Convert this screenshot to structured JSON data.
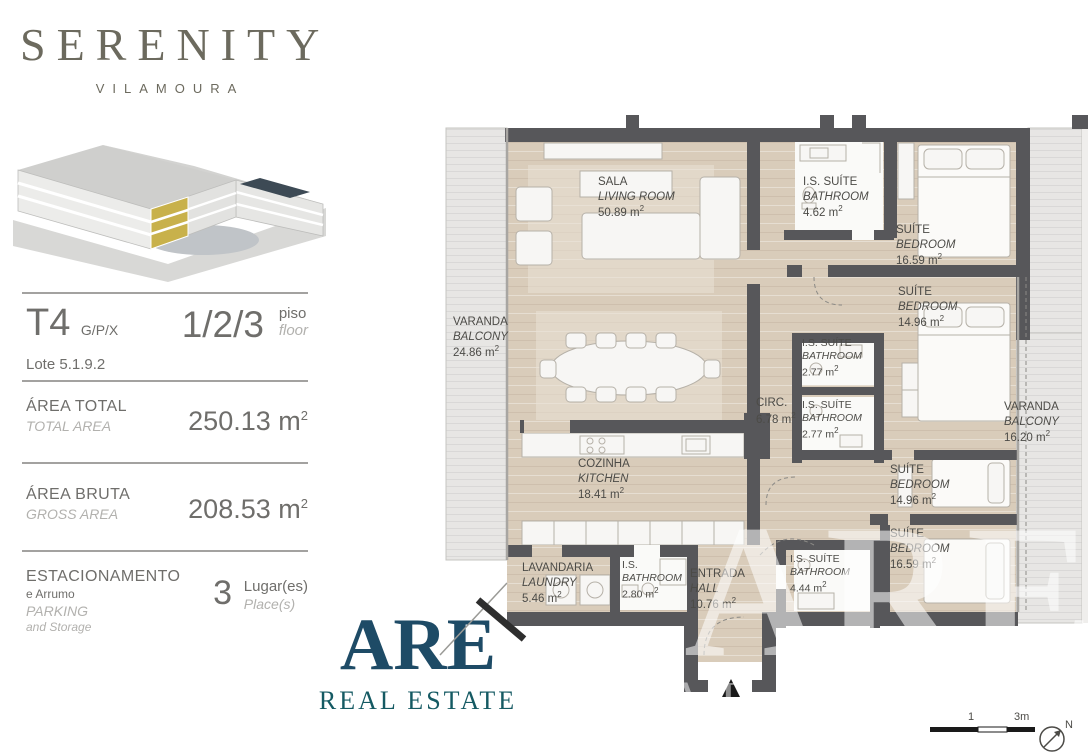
{
  "brand": {
    "name": "SERENITY",
    "location": "VILAMOURA"
  },
  "unit": {
    "type": "T4",
    "type_suffix": "G/P/X",
    "floors": "1/2/3",
    "floors_label_pt": "piso",
    "floors_label_en": "floor",
    "lot": "Lote 5.1.9.2",
    "unit_symbol": "m",
    "unit_exp": "2",
    "area_total": {
      "label_pt": "ÁREA TOTAL",
      "label_en": "TOTAL AREA",
      "value": "250.13"
    },
    "area_gross": {
      "label_pt": "ÁREA BRUTA",
      "label_en": "GROSS AREA",
      "value": "208.53"
    },
    "parking": {
      "label_pt": "ESTACIONAMENTO",
      "label_pt_sub": "e Arrumo",
      "label_en": "PARKING",
      "label_en_sub": "and Storage",
      "value": "3",
      "unit_pt": "Lugar(es)",
      "unit_en": "Place(s)"
    }
  },
  "agency": {
    "name": "ARE",
    "tagline": "REAL ESTATE"
  },
  "floorplan": {
    "unit_symbol": "m",
    "unit_exp": "2",
    "rooms": [
      {
        "id": "living",
        "pt": "SALA",
        "en": "LIVING ROOM",
        "area": "50.89"
      },
      {
        "id": "bath-suite-1",
        "pt": "I.S. SUÍTE",
        "en": "BATHROOM",
        "area": "4.62"
      },
      {
        "id": "suite-1",
        "pt": "SUÍTE",
        "en": "BEDROOM",
        "area": "16.59"
      },
      {
        "id": "suite-2",
        "pt": "SUÍTE",
        "en": "BEDROOM",
        "area": "14.96"
      },
      {
        "id": "balcony-left",
        "pt": "VARANDA",
        "en": "BALCONY",
        "area": "24.86"
      },
      {
        "id": "bath-suite-2",
        "pt": "I.S. SUÍTE",
        "en": "BATHROOM",
        "area": "2.77"
      },
      {
        "id": "circulation",
        "pt": "CIRC.",
        "en": "",
        "area": "6.78"
      },
      {
        "id": "bath-suite-3",
        "pt": "I.S. SUÍTE",
        "en": "BATHROOM",
        "area": "2.77"
      },
      {
        "id": "balcony-right",
        "pt": "VARANDA",
        "en": "BALCONY",
        "area": "16.20"
      },
      {
        "id": "kitchen",
        "pt": "COZINHA",
        "en": "KITCHEN",
        "area": "18.41"
      },
      {
        "id": "suite-3",
        "pt": "SUÍTE",
        "en": "BEDROOM",
        "area": "14.96"
      },
      {
        "id": "suite-4",
        "pt": "SUÍTE",
        "en": "BEDROOM",
        "area": "16.59"
      },
      {
        "id": "laundry",
        "pt": "LAVANDARIA",
        "en": "LAUNDRY",
        "area": "5.46"
      },
      {
        "id": "bath",
        "pt": "I.S.",
        "en": "BATHROOM",
        "area": "2.80"
      },
      {
        "id": "hall",
        "pt": "ENTRADA",
        "en": "HALL",
        "area": "10.76"
      },
      {
        "id": "bath-suite-4",
        "pt": "I.S. SUÍTE",
        "en": "BATHROOM",
        "area": "4.44"
      }
    ],
    "scale": {
      "tick_mid": "1",
      "tick_end": "3m"
    },
    "compass": "N",
    "watermark": {
      "line1": "ARE",
      "line2": "REAL ESTATE"
    }
  },
  "colors": {
    "accent_gold": "#c8b14b",
    "brand_text": "#6c6a5e",
    "agency_blue": "#1e4b66",
    "agency_teal": "#155a63",
    "wall": "#57575a",
    "floor": "#d9ccba",
    "balcony": "#e6e5e3"
  }
}
